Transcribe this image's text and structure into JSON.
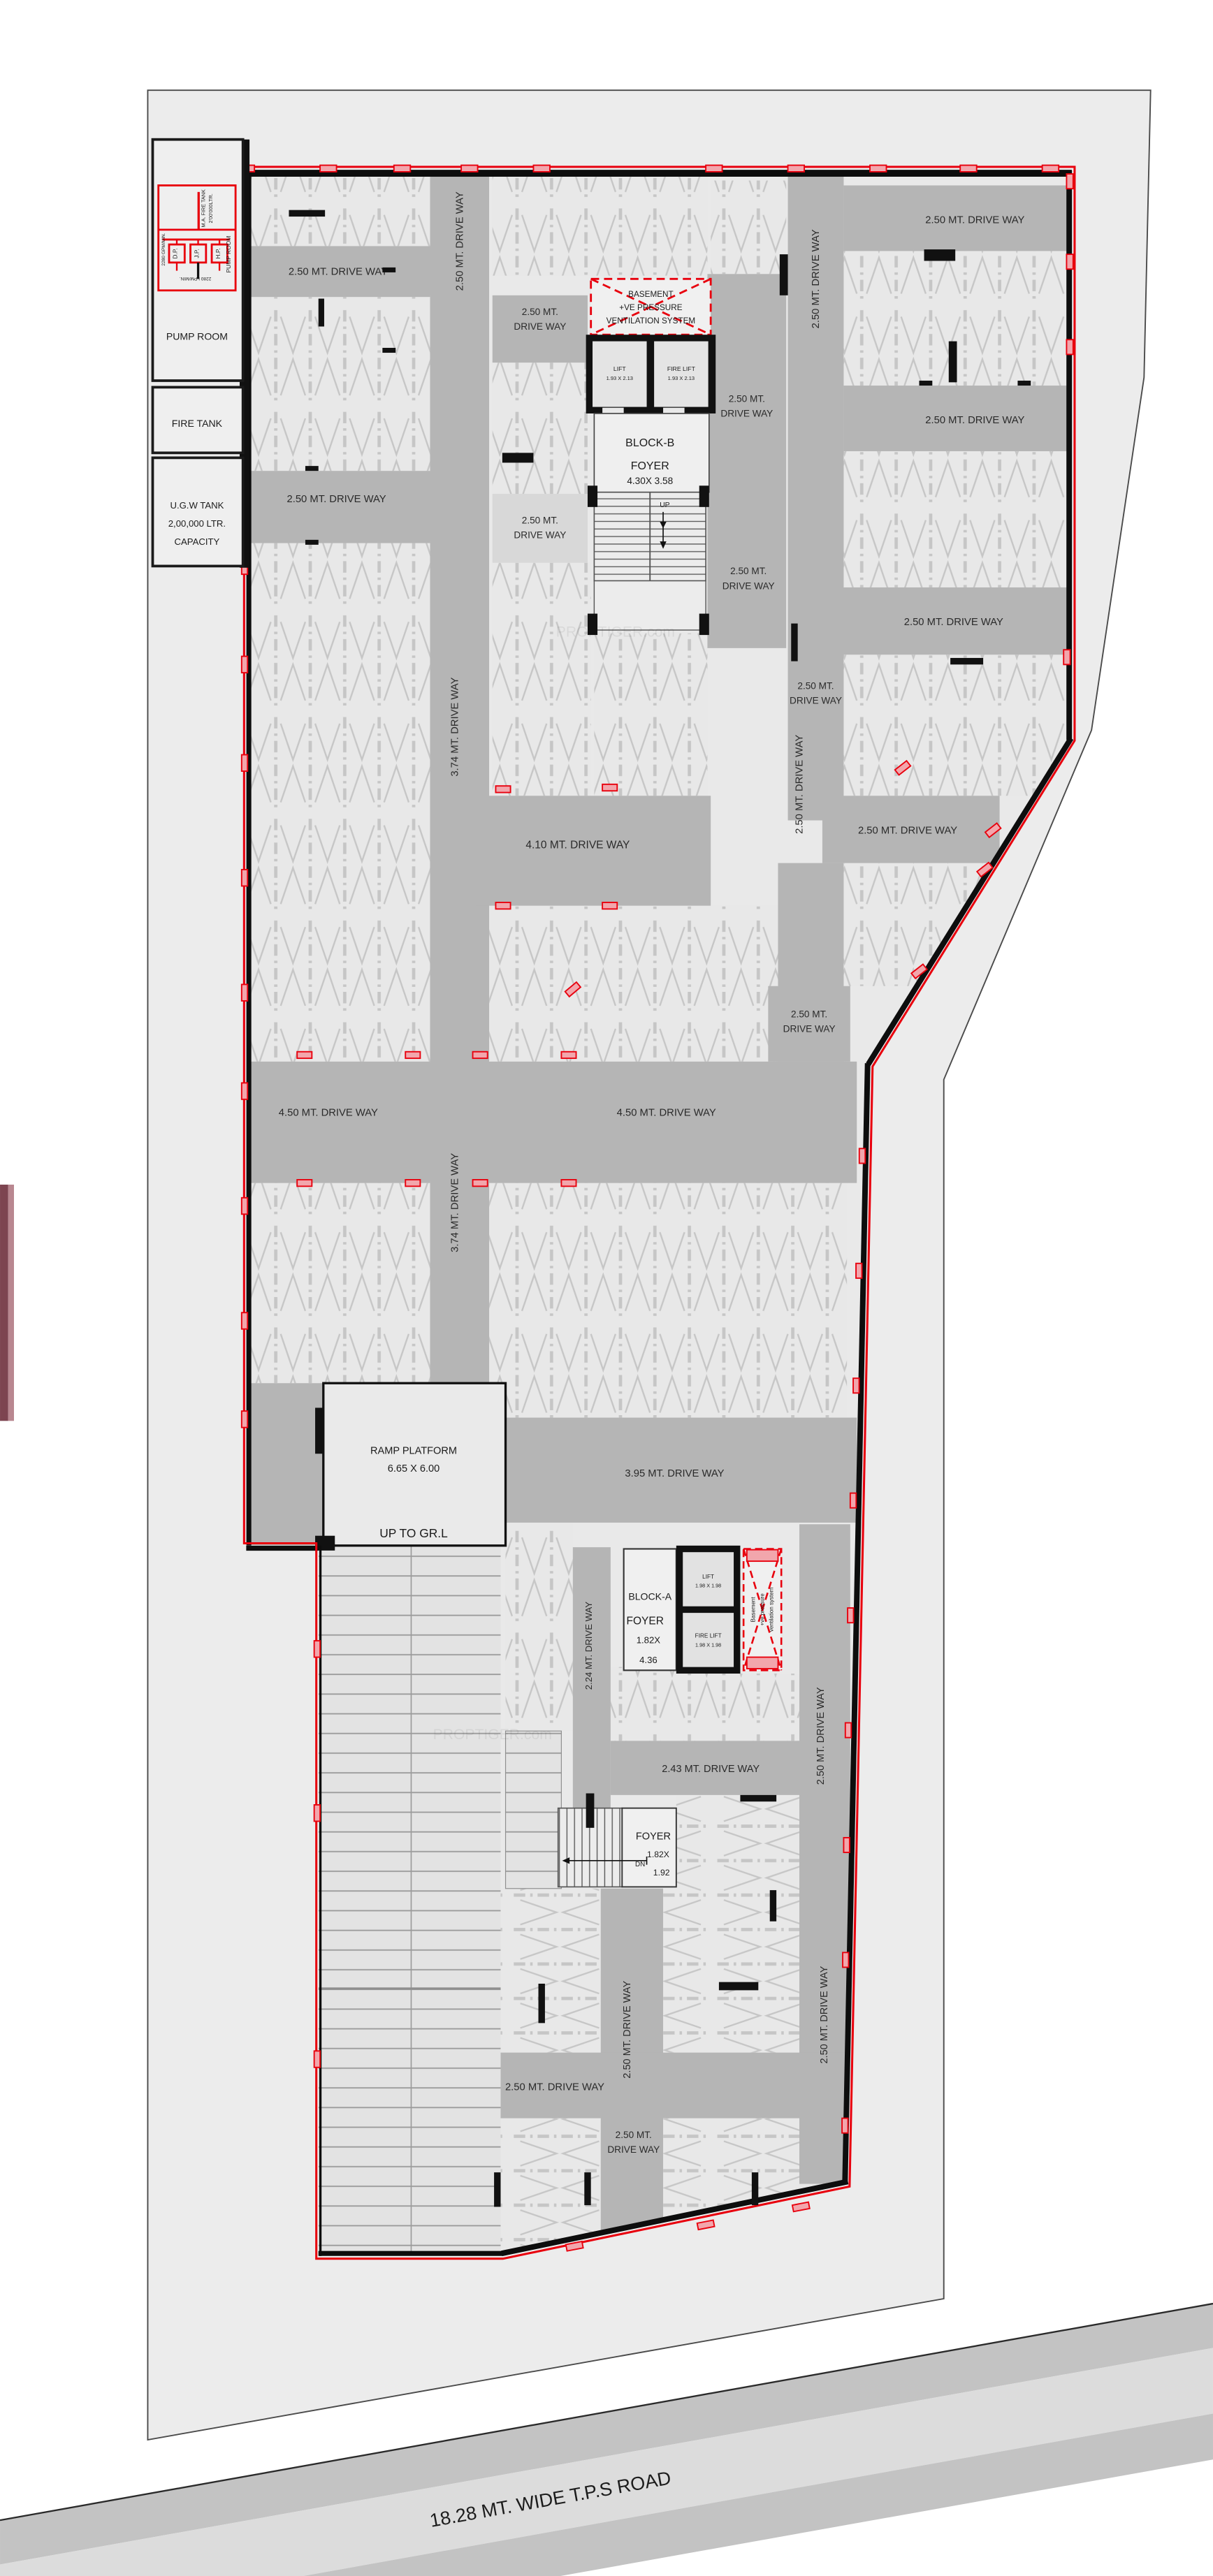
{
  "road": {
    "name": "18.28 MT. WIDE T.P.S ROAD"
  },
  "watermark": "PROPTIGER.com",
  "utility": {
    "pump_room": "PUMP ROOM",
    "fire_tank": "FIRE TANK",
    "ugw_line1": "U.G.W TANK",
    "ugw_line2": "2,00,000 LTR.",
    "ugw_line3": "CAPACITY",
    "schematic_tank": "M.A. FIRE TANK",
    "schematic_tank2": "2'00'000LTR.",
    "schematic_room": "PUMP ROOM",
    "pump1": "D.P.",
    "pump2": "J.P.",
    "pump3": "H.P.",
    "flow_top": "2280 GPM/MIN.",
    "flow_bottom": "2280 LPM/MIN."
  },
  "drive_labels": {
    "w250": "2.50 MT. DRIVE WAY",
    "w250_l1": "2.50 MT.",
    "w250_l2": "DRIVE WAY",
    "w374": "3.74 MT. DRIVE WAY",
    "w410": "4.10 MT. DRIVE WAY",
    "w450": "4.50 MT. DRIVE WAY",
    "w395": "3.95 MT. DRIVE WAY",
    "w243": "2.43 MT. DRIVE WAY",
    "w224": "2.24 MT. DRIVE WAY"
  },
  "block_b": {
    "vent_l1": "BASEMENT",
    "vent_l2": "+VE PRESSURE",
    "vent_l3": "VENTILATION SYSTEM",
    "lift": "LIFT",
    "lift_size": "1.93 X 2.13",
    "fire_lift": "FIRE LIFT",
    "fire_lift_size": "1.93 X 2.13",
    "name": "BLOCK-B",
    "foyer": "FOYER",
    "foyer_size": "4.30X 3.58",
    "up": "UP"
  },
  "block_a": {
    "name": "BLOCK-A",
    "foyer": "FOYER",
    "foyer_size_l1": "1.82X",
    "foyer_size_l2": "4.36",
    "lift": "LIFT",
    "lift_size": "1.98 X 1.98",
    "fire_lift": "FIRE LIFT",
    "fire_lift_size": "1.98 X 1.98",
    "vent_l1": "Basement",
    "vent_l2": "+ve pressure",
    "vent_l3": "ventilation system"
  },
  "ramp": {
    "platform_l1": "RAMP PLATFORM",
    "platform_l2": "6.65 X 6.00",
    "up": "UP TO GR.L"
  },
  "stair_foyer": {
    "name": "FOYER",
    "size_l1": "1.82X",
    "size_l2": "1.92",
    "dn": "DN"
  }
}
